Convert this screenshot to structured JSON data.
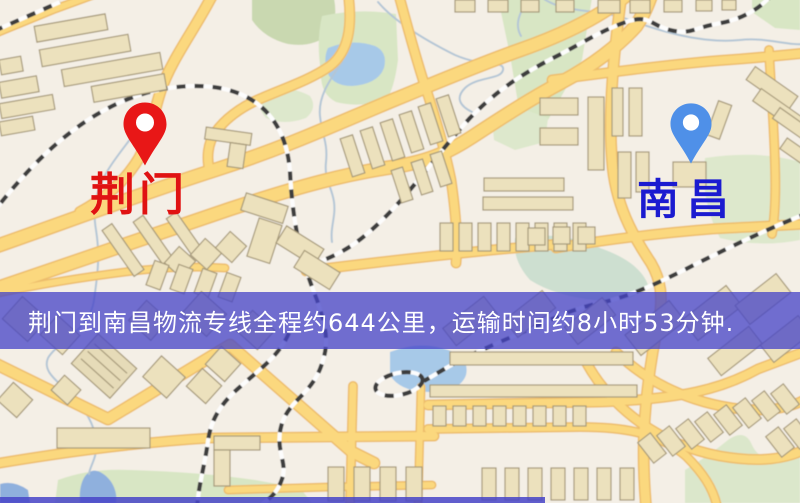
{
  "map": {
    "origin": {
      "name": "荆门",
      "pin_color": "#e81717",
      "label_color": "#e01212"
    },
    "destination": {
      "name": "南昌",
      "pin_color": "#4f90e8",
      "label_color": "#1b1bd0"
    }
  },
  "banner": {
    "text": "荆门到南昌物流专线全程约644公里，运输时间约8小时53分钟.",
    "distance": "644公里",
    "duration": "8小时53分钟",
    "background": "#4644c8",
    "text_color": "#ffffff"
  },
  "palette": {
    "map_background": "#f4efe6",
    "road_fill": "#fbd87e",
    "road_casing": "#edbd6c",
    "building_fill": "#ece1bd",
    "building_stroke": "#a59878",
    "park_green": "#d8e6c4",
    "water_blue": "#a7c9e8",
    "railway_dark": "#3c3c3c",
    "railway_light": "#fdfdfd"
  }
}
